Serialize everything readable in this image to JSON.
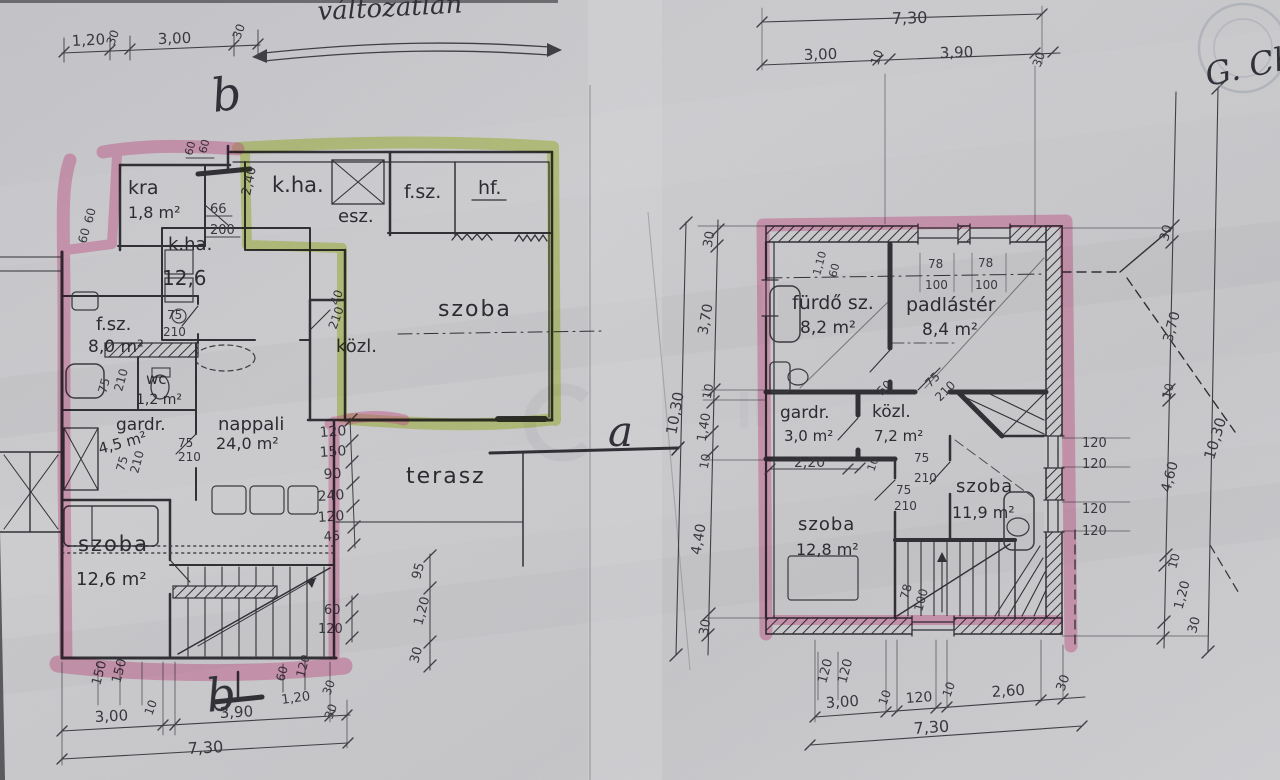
{
  "annotations": {
    "unchanged": "változatlan",
    "section_b": "b",
    "section_a": "a",
    "signature": "G. Ch."
  },
  "left_plan": {
    "rooms": [
      {
        "name": "kra",
        "area": "1,8 m²"
      },
      {
        "name": "k.ha.",
        "area": "12,6"
      },
      {
        "name": "k.ha.",
        "area": ""
      },
      {
        "name": "esz.",
        "area": ""
      },
      {
        "name": "f.sz.",
        "area": ""
      },
      {
        "name": "hf.",
        "area": ""
      },
      {
        "name": "szoba",
        "area": ""
      },
      {
        "name": "közl.",
        "area": ""
      },
      {
        "name": "f.sz.",
        "area": "8,0 m²"
      },
      {
        "name": "wc",
        "area": "1,2 m²"
      },
      {
        "name": "gardr.",
        "area": "4,5 m²"
      },
      {
        "name": "nappali",
        "area": "24,0 m²"
      },
      {
        "name": "szoba",
        "area": "12,6 m²"
      },
      {
        "name": "terasz",
        "area": ""
      }
    ],
    "dims": {
      "top": [
        "1,20",
        "30",
        "3,00",
        "30"
      ],
      "bottom": [
        "3,00",
        "10",
        "3,90",
        "30",
        "30"
      ],
      "bottom_total": "7,30",
      "bottom_small": [
        "60",
        "120",
        "1,20"
      ],
      "left_small": [
        "60",
        "60"
      ],
      "stair_width": [
        "150",
        "150"
      ],
      "door_kra": [
        "66",
        "200"
      ],
      "door_fsz": [
        "75",
        "210"
      ],
      "door_wc": [
        "75",
        "210"
      ],
      "door_gardr": [
        "75",
        "210"
      ],
      "door_gardr2": [
        "75",
        "210"
      ],
      "door_kozl": [
        "40",
        "210"
      ],
      "chain": [
        "120",
        "150",
        "90",
        "240",
        "120",
        "45"
      ],
      "chain_lower": [
        "60",
        "120"
      ],
      "right_rot": [
        "95",
        "1,20",
        "30"
      ],
      "height": "2,40",
      "top_small": [
        "60",
        "60"
      ]
    }
  },
  "right_plan": {
    "rooms": [
      {
        "name": "fürdő sz.",
        "area": "8,2 m²"
      },
      {
        "name": "padlástér",
        "area": "8,4 m²"
      },
      {
        "name": "gardr.",
        "area": "3,0 m²"
      },
      {
        "name": "közl.",
        "area": "7,2 m²"
      },
      {
        "name": "szoba",
        "area": "12,8 m²"
      },
      {
        "name": "szoba",
        "area": "11,9 m²"
      }
    ],
    "dims": {
      "top_total": "7,30",
      "top": [
        "3,00",
        "10",
        "3,90",
        "30"
      ],
      "left": [
        "30",
        "3,70",
        "10",
        "1,40",
        "10",
        "4,40",
        "30"
      ],
      "left_total": "10,30",
      "right": [
        "30",
        "3,70",
        "10",
        "4,60",
        "10",
        "1,20",
        "30"
      ],
      "right_total": "10,30",
      "bottom": [
        "3,00",
        "10",
        "120",
        "10",
        "2,60",
        "30"
      ],
      "bottom_total": "7,30",
      "bottom_small": [
        "120",
        "120"
      ],
      "window1": [
        "78",
        "100"
      ],
      "window2": [
        "78",
        "100"
      ],
      "window3": [
        "78",
        "100"
      ],
      "right_windows": [
        "120",
        "120",
        "120",
        "120"
      ],
      "door1": [
        "75",
        "210"
      ],
      "door2": [
        "75",
        "210"
      ],
      "door3": [
        "75",
        "210"
      ],
      "gardr_width": [
        "2,20",
        "10"
      ],
      "small": [
        "50",
        "1,10",
        "60"
      ]
    }
  }
}
